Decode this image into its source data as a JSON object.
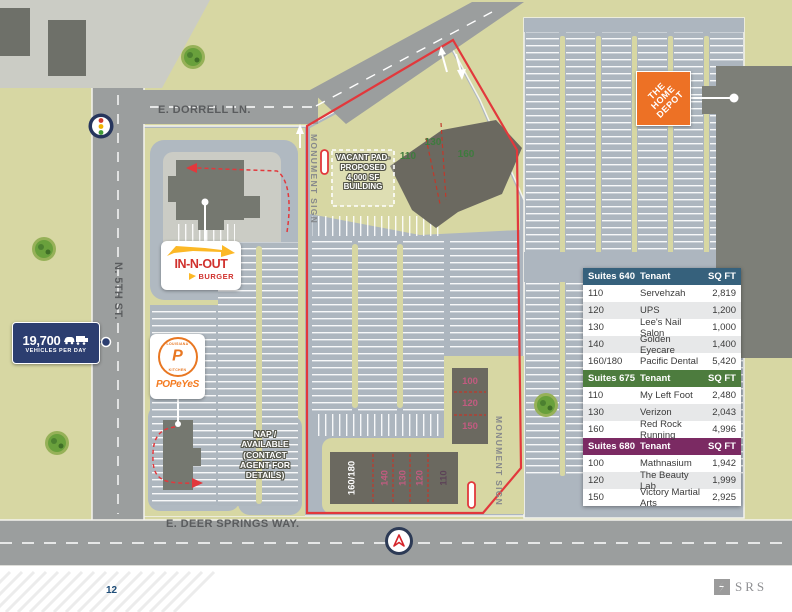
{
  "page": {
    "number": "12",
    "brand": "SRS"
  },
  "streets": {
    "dorrell": "E. DORRELL LN.",
    "fifth": "N. 5TH ST.",
    "deer_springs": "E. DEER SPRINGS WAY."
  },
  "annotations": {
    "monument_sign_north": "MONUMENT SIGN",
    "monument_sign_south": "MONUMENT SIGN",
    "vacant_pad": "VACANT PAD-\nPROPOSED\n4,000 SF\nBUILDING",
    "nap_available": "NAP /\nAVAILABLE\n(CONTACT\nAGENT FOR\nDETAILS)",
    "traffic_count": "19,700",
    "traffic_unit": "VEHICLES PER DAY"
  },
  "logos": {
    "home_depot": "THE\nHOME\nDEPOT",
    "in_n_out_top": "IN-N-OUT",
    "in_n_out_bottom": "BURGER",
    "popeyes_ring_top": "LOUISIANA",
    "popeyes_ring_bottom": "KITCHEN",
    "popeyes_p": "P",
    "popeyes_name": "POPeYeS"
  },
  "suite_labels": {
    "pad": [
      "110",
      "130",
      "160"
    ],
    "east": [
      "100",
      "120",
      "150"
    ],
    "south": [
      "160/180",
      "140",
      "130",
      "120",
      "110"
    ]
  },
  "tables": [
    {
      "header": {
        "suites": "Suites 640",
        "tenant": "Tenant",
        "sqft": "SQ FT"
      },
      "rows": [
        [
          "110",
          "Servehzah",
          "2,819"
        ],
        [
          "120",
          "UPS",
          "1,200"
        ],
        [
          "130",
          "Lee's Nail Salon",
          "1,000"
        ],
        [
          "140",
          "Golden Eyecare",
          "1,400"
        ],
        [
          "160/180",
          "Pacific Dental",
          "5,420"
        ]
      ]
    },
    {
      "header": {
        "suites": "Suites 675",
        "tenant": "Tenant",
        "sqft": "SQ FT"
      },
      "rows": [
        [
          "110",
          "My Left Foot",
          "2,480"
        ],
        [
          "130",
          "Verizon",
          "2,043"
        ],
        [
          "160",
          "Red Rock Running",
          "4,996"
        ]
      ]
    },
    {
      "header": {
        "suites": "Suites 680",
        "tenant": "Tenant",
        "sqft": "SQ FT"
      },
      "rows": [
        [
          "100",
          "Mathnasium",
          "1,942"
        ],
        [
          "120",
          "The Beauty Lab",
          "1,999"
        ],
        [
          "150",
          "Victory Martial Arts",
          "2,925"
        ]
      ]
    }
  ],
  "colors": {
    "boundary_red": "#e2383c",
    "table_blue": "#36617c",
    "table_green": "#4d7c3e",
    "table_purple": "#7b2a63",
    "home_depot_orange": "#ed7125",
    "in_n_out_red": "#d0312d",
    "popeyes_orange": "#e87722",
    "badge_navy": "#2c3e70",
    "land_tan": "#d7d7a3",
    "parking_gray": "#adb6bf"
  }
}
